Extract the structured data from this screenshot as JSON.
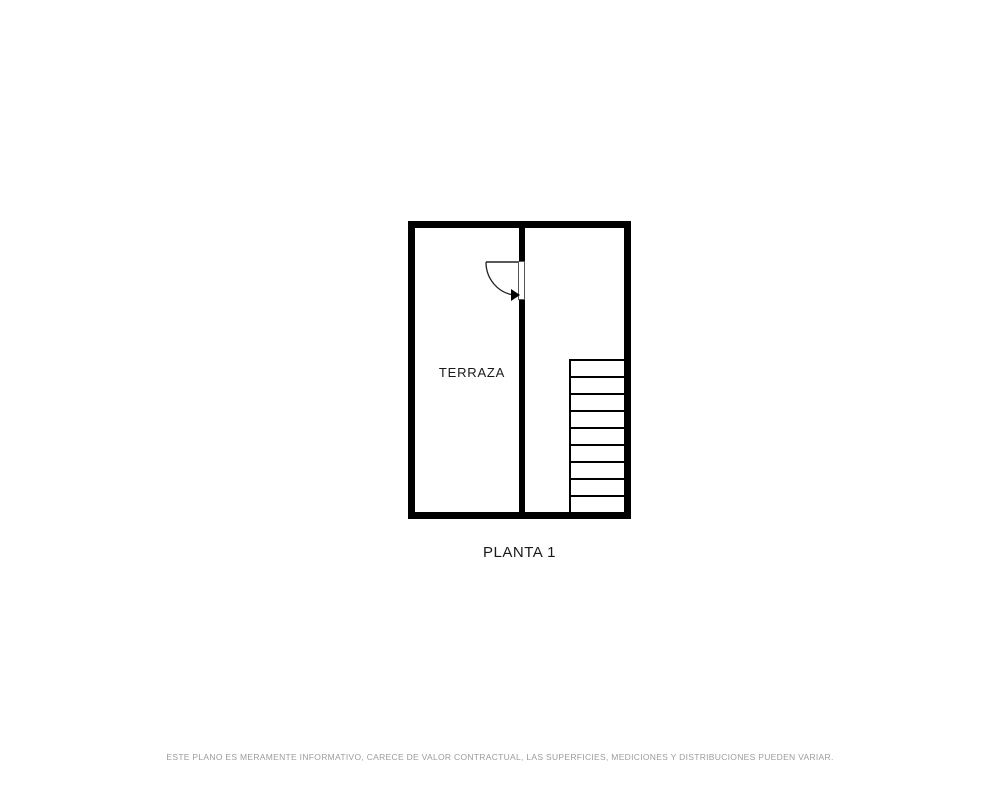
{
  "floorplan": {
    "room_label": "TERRAZA",
    "title": "PLANTA 1",
    "disclaimer": "ESTE PLANO ES MERAMENTE INFORMATIVO, CARECE DE VALOR CONTRACTUAL, LAS SUPERFICIES, MEDICIONES Y DISTRIBUCIONES PUEDEN VARIAR.",
    "stairs": {
      "steps": 9
    },
    "colors": {
      "wall": "#000000",
      "thin_line": "#222222",
      "label_text": "#1a1a1a",
      "disclaimer_text": "#9c9c9c",
      "background": "#ffffff"
    }
  }
}
